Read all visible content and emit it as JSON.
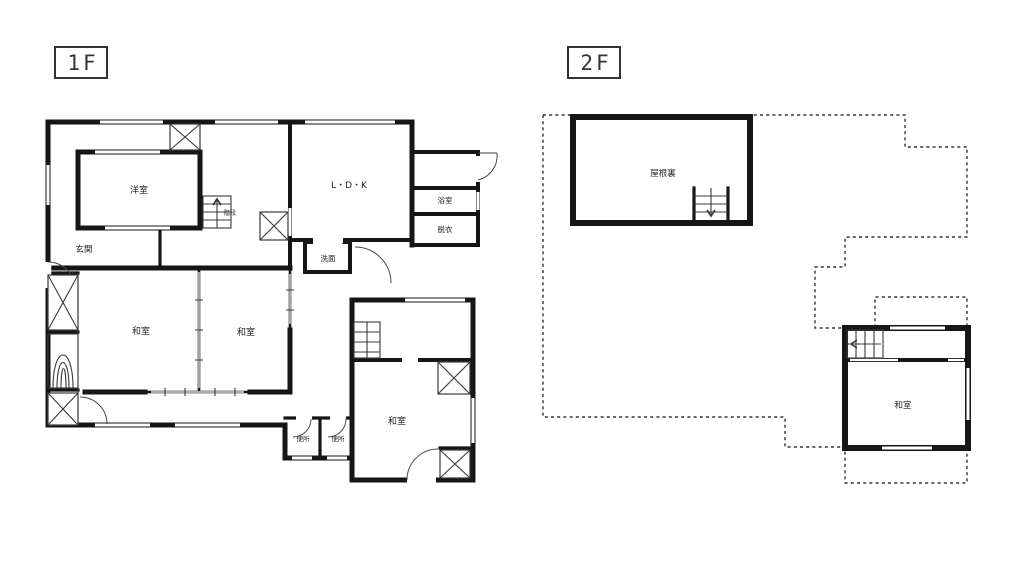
{
  "colors": {
    "wall": "#161616",
    "line": "#3a3a3a",
    "dotted_outline": "#333333",
    "background": "#ffffff",
    "text": "#1f1f1f"
  },
  "icons": {
    "stairs_up_arrow": "↑",
    "stairs_down_arrow": "↓",
    "stairs_left_arrow": "←",
    "closet_hatch": "X",
    "door_swing": "quarter-arc",
    "window": "double-line",
    "tokonoma": "nested-arches"
  },
  "floor1": {
    "tag": "1F",
    "rooms": {
      "western": "洋室",
      "entrance": "玄関",
      "stairs": "階段",
      "ldk": "L・D・K",
      "bath": "浴室",
      "dressing": "脱衣",
      "washstand": "洗面",
      "tatami_left": "和室",
      "tatami_right": "和室",
      "tatami_south": "和室",
      "toilet_a": "便所",
      "toilet_b": "便所"
    }
  },
  "floor2": {
    "tag": "2F",
    "rooms": {
      "attic": "屋根裏",
      "tatami": "和室"
    }
  }
}
